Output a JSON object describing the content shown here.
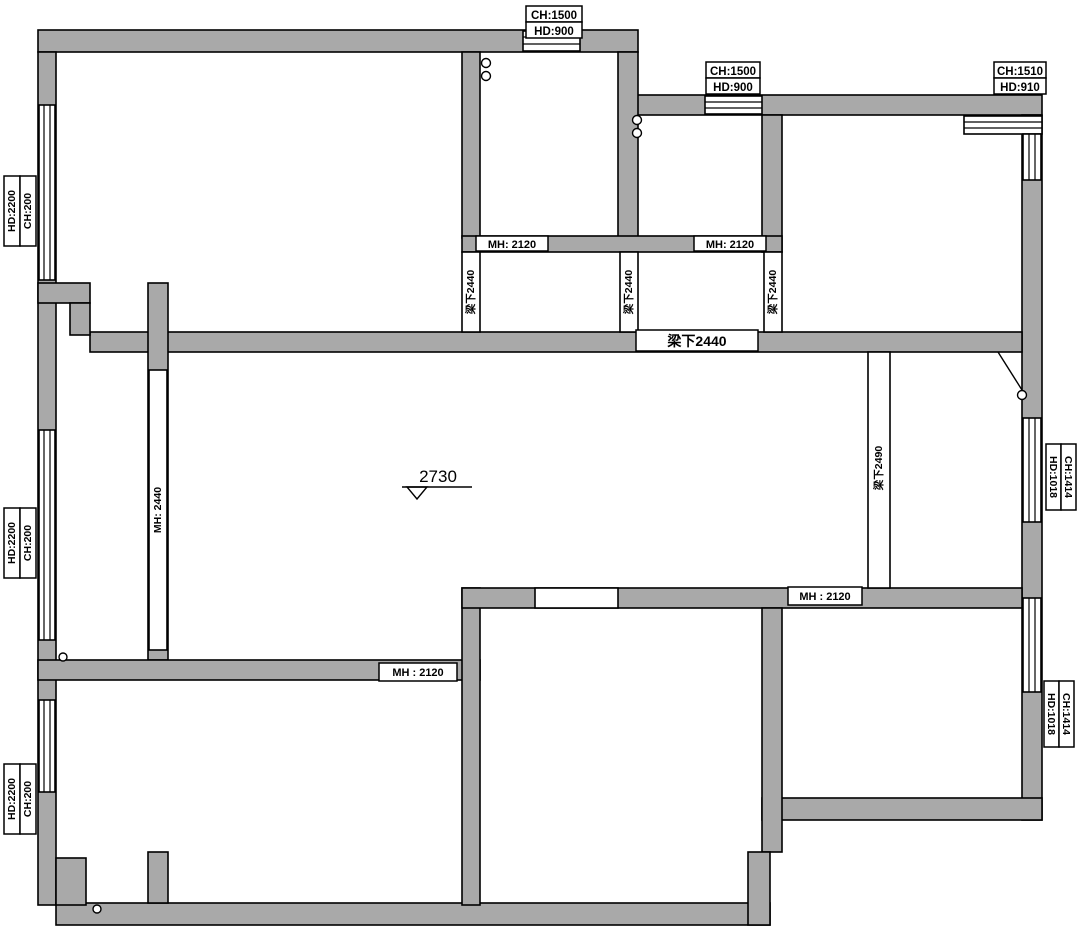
{
  "drawing": {
    "type": "floor-plan",
    "wall_color": "#a9a9a9",
    "line_color": "#000000",
    "background": "#ffffff"
  },
  "window_labels": {
    "top_center": {
      "l1": "CH:1500",
      "l2": "HD:900"
    },
    "top_right": {
      "l1": "CH:1500",
      "l2": "HD:900"
    },
    "top_corner": {
      "l1": "CH:1510",
      "l2": "HD:910"
    },
    "left_upper": {
      "l1": "HD:2200",
      "l2": "CH:200"
    },
    "left_middle": {
      "l1": "HD:2200",
      "l2": "CH:200"
    },
    "left_lower": {
      "l1": "HD:2200",
      "l2": "CH:200"
    },
    "right_upper": {
      "l1": "HD:1018",
      "l2": "CH:1414"
    },
    "right_lower": {
      "l1": "HD:1018",
      "l2": "CH:1414"
    }
  },
  "door_labels": {
    "top_left_door": "MH: 2120",
    "top_right_door": "MH: 2120",
    "living_left_door": "MH: 2440",
    "bottom_left_door": "MH : 2120",
    "bottom_right_door": "MH : 2120"
  },
  "beam_labels": {
    "beam_v1": "梁下2440",
    "beam_v2": "梁下2440",
    "beam_v3": "梁下2440",
    "beam_h": "梁下2440",
    "beam_right": "梁下2490"
  },
  "level_mark": {
    "value": "2730"
  }
}
